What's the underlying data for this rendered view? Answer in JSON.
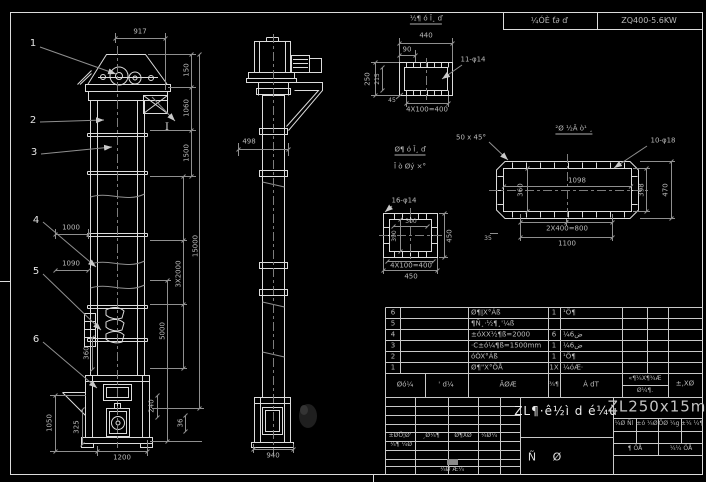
{
  "drawing": {
    "header": {
      "process_note": "¼ÓÈ ť∂ ď",
      "power_spec": "ZQ400-5.6KW"
    },
    "front_view": {
      "callouts": [
        "1",
        "2",
        "3",
        "4",
        "5",
        "6"
      ],
      "section_mark": "I",
      "dims": {
        "top_width": "917",
        "head_h": "150",
        "head_h2": "1060",
        "upper_h": "1500",
        "total_h": "15000",
        "sections": "3X2000",
        "lower_h": "5000",
        "w1": "1000",
        "w2": "1090",
        "chute_h": "360",
        "boot_h": "1050",
        "door_h": "325",
        "base_w": "1200",
        "foot_h": "240",
        "plate_t": "36"
      }
    },
    "side_view": {
      "dims": {
        "casing_w": "498",
        "base_w": "940"
      }
    },
    "detail_top_flange": {
      "title": "½¶ ó Ī¸ ď",
      "holes": "11-φ14",
      "dims": {
        "w": "440",
        "offset": "90",
        "h": "250",
        "h2": "215",
        "weld": "45",
        "pitch": "4X100=400"
      }
    },
    "notes": {
      "line1": "Ø¶ ó Ī¸ ď",
      "line2": "Ī ò Øý ×°"
    },
    "detail_shell": {
      "title": "²Ø ½Ã ò¹ ¸",
      "chamfer": "50 x 45°",
      "holes": "10-φ18",
      "dims": {
        "inner_w": "1098",
        "inner_h": "360",
        "h1": "398",
        "h2": "470",
        "pitch": "2X400=800",
        "w": "1100",
        "t": "35"
      }
    },
    "detail_square_flange": {
      "holes": "16-φ14",
      "dims": {
        "inner_w": "300",
        "inner_h": "390",
        "h": "450",
        "pitch": "4X100=400",
        "w": "450"
      }
    },
    "bom": {
      "headers": {
        "seq": "Øó¼",
        "code": "' d¼",
        "name": "ÃØÆ",
        "qty": "¾¶",
        "material": "Á dT",
        "weight_top": "«¶¼X¶¾Æ",
        "weight_bottom": "Ø¼¶.",
        "remark": "±,XØ"
      },
      "rows": [
        {
          "no": "6",
          "name": "Ø¶ĮX°Áß",
          "qty": "1",
          "material": "¹Ö¶"
        },
        {
          "no": "5",
          "name": "¶Ñ¸·½¶¸'¼ß",
          "qty": "",
          "material": ""
        },
        {
          "no": "4",
          "name": "±óXX½¶ß=2000",
          "qty": "6",
          "material": "¼6ض"
        },
        {
          "no": "3",
          "name": "·C±ó¼¶ß=1500mm",
          "qty": "1",
          "material": "¼6ض"
        },
        {
          "no": "2",
          "name": "óÒX°Áß",
          "qty": "1",
          "material": "¹Ö¶"
        },
        {
          "no": "1",
          "name": "Ø¶\"X°ÖÅ",
          "qty": "1X",
          "material": "¼óÆ·"
        }
      ]
    },
    "title_block": {
      "title": "ZL¶·ê½ì d é¼ù",
      "model": "ZL250x15m",
      "sig_labels": [
        "±ØÖ¦Ø'",
        "¸Ø¼¶",
        "Ø¶XØ",
        "¼Ø¼"
      ],
      "sig_row2": "¼¶ ¼Ø",
      "sig_footer": "¼Ø Æ¼",
      "stage_left": "Ñ",
      "stage_right": "Ø",
      "info_labels": [
        "¼Ø Ñl",
        "±ó ¼Ø",
        "ÖØ ¼g",
        "±¼ ¼¶"
      ],
      "sheet_left": "¶ ÖÅ",
      "sheet_right": "¼¼ ÖÅ"
    }
  }
}
